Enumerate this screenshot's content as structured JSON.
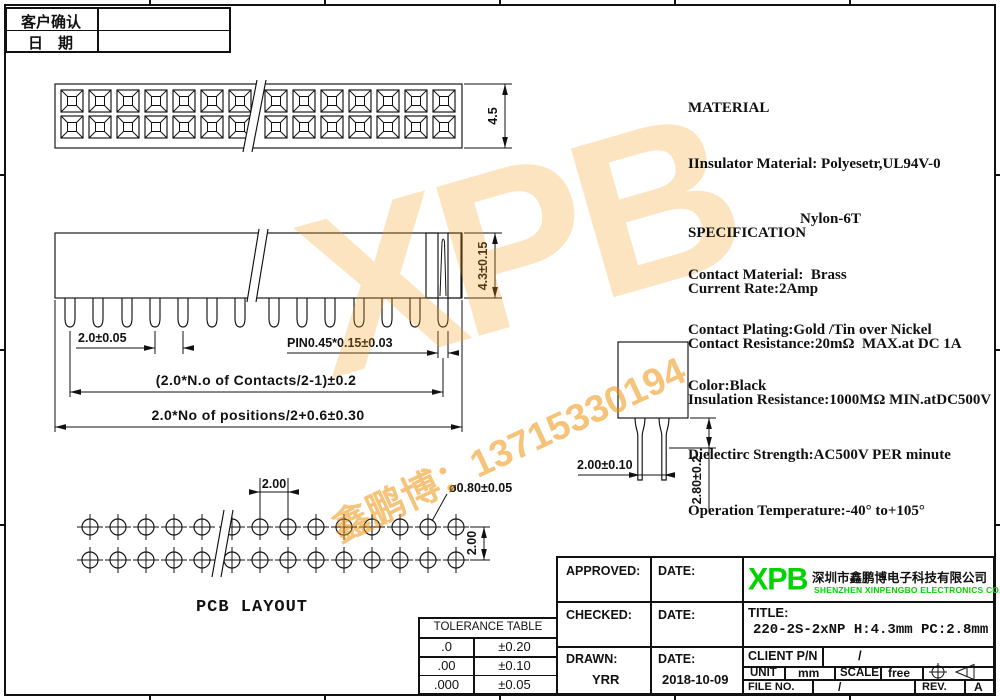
{
  "confirm_table": {
    "rows": [
      {
        "label": "客户确认",
        "value": ""
      },
      {
        "label": "日　期",
        "value": ""
      }
    ]
  },
  "material": {
    "lines": [
      "MATERIAL",
      "IInsulator Material: Polyesetr,UL94V-0",
      "Nylon-6T",
      "Contact Material:  Brass",
      "Contact Plating:Gold /Tin over Nickel",
      "Color:Black"
    ]
  },
  "specification": {
    "lines": [
      "SPECIFICATION",
      "Current Rate:2Amp",
      "Contact Resistance:20mΩ  MAX.at DC 1A",
      "Insulation Resistance:1000MΩ MIN.atDC500V",
      "Dielectirc Strength:AC500V PER minute",
      "Operation Temperature:-40° to+105°"
    ]
  },
  "dimensions": {
    "top_height": "4.5",
    "pin_pitch": "2.0±0.05",
    "pin_size": "PIN0.45*0.15±0.03",
    "contacts_span": "(2.0*N.o of Contacts/2-1)±0.2",
    "positions_span": "2.0*No of positions/2+0.6±0.30",
    "body_height": "4.3±0.15",
    "side_pin_spacing": "2.00±0.10",
    "side_tail_length": "2.80±0.2",
    "pcb_pitch": "2.00",
    "pcb_hole_dia": "ø0.80±0.05",
    "pcb_row_pitch": "2.00",
    "pcb_label": "PCB  LAYOUT"
  },
  "tolerance_table": {
    "title": "TOLERANCE TABLE",
    "rows": [
      [
        ".0",
        "±0.20"
      ],
      [
        ".00",
        "±0.10"
      ],
      [
        ".000",
        "±0.05"
      ]
    ]
  },
  "title_block": {
    "approved_label": "APPROVED:",
    "checked_label": "CHECKED:",
    "drawn_label": "DRAWN:",
    "date_label": "DATE:",
    "drawn_by": "YRR",
    "drawn_date": "2018-10-09",
    "logo_text": "XPB",
    "company_cn": "深圳市鑫鹏博电子科技有限公司",
    "company_en": "SHENZHEN XINPENGBO ELECTRONICS CO.LTD",
    "title_label": "TITLE:",
    "title_value": "220-2S-2xNP H:4.3mm PC:2.8mm",
    "client_label": "CLIENT P/N",
    "client_value": "/",
    "unit_label": "UNIT",
    "unit_value": "mm",
    "scale_label": "SCALE",
    "scale_value": "free",
    "file_label": "FILE NO.",
    "file_value": "/",
    "rev_label": "REV.",
    "rev_value": "A"
  },
  "watermark": {
    "logo": "XPB",
    "phone": "鑫鹏博：13715330194",
    "color": "#f0930f"
  },
  "colors": {
    "logo_green": "#00d400",
    "line": "#111111"
  },
  "geometry": {
    "top_cells_left": 7,
    "top_cells_right": 7,
    "front_pins_left": 7,
    "front_pins_right": 7,
    "pcb_cols_left": 5,
    "pcb_cols_right": 9,
    "pcb_rows": 2
  }
}
